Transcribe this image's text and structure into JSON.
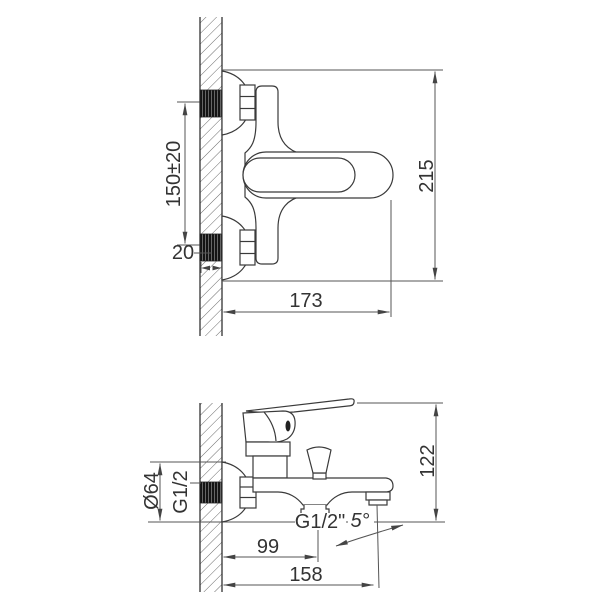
{
  "colors": {
    "object_line": "#3a3a3a",
    "dimension_line": "#555555",
    "text": "#333333",
    "thread_fill": "#111111",
    "background": "#ffffff"
  },
  "front_view": {
    "dims": {
      "inlet_centres": "150±20",
      "wall_thread_length": "20",
      "projection_depth": "173",
      "overall_width": "215"
    }
  },
  "side_view": {
    "dims": {
      "escutcheon_diameter": "Ø64",
      "inlet_thread": "G1/2",
      "overall_height": "122",
      "shower_outlet_thread": "G1/2\"",
      "spout_angle": "5°",
      "shower_outlet_offset": "99",
      "spout_reach": "158"
    }
  }
}
